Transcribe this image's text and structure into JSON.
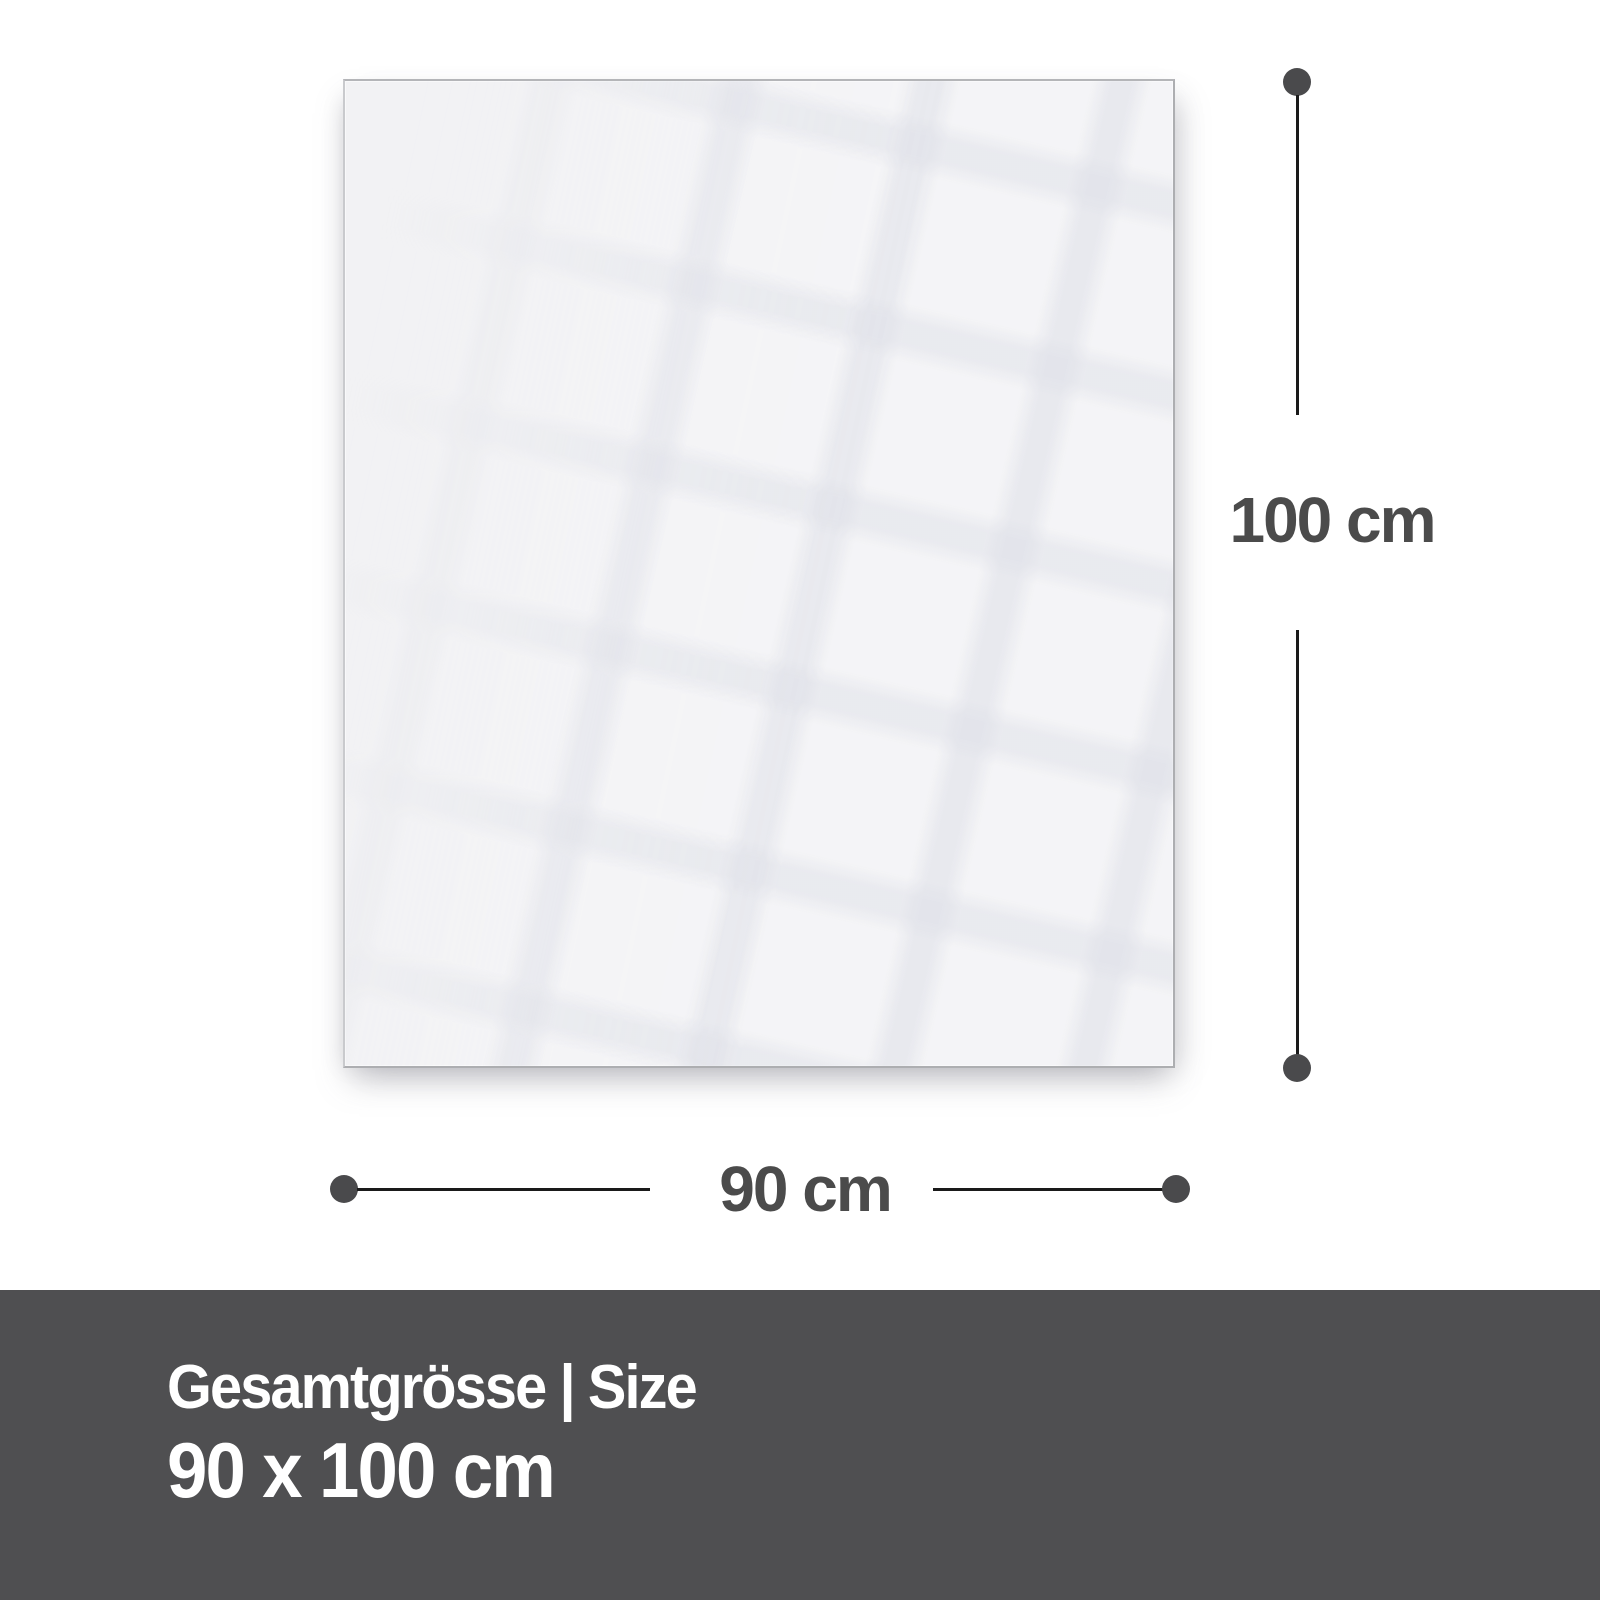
{
  "diagram": {
    "panel": {
      "fill": "#f2f2f4",
      "border_color": "#adaeb1"
    },
    "height_dimension": {
      "label": "100 cm"
    },
    "width_dimension": {
      "label": "90 cm"
    },
    "line_color": "#1a1a1a",
    "dot_color": "#4a4a4c",
    "label_color": "#4b4b4b"
  },
  "footer": {
    "title": "Gesamtgrösse | Size",
    "size": "90 x 100 cm",
    "background": "#4f4f51",
    "text_color": "#ffffff"
  }
}
